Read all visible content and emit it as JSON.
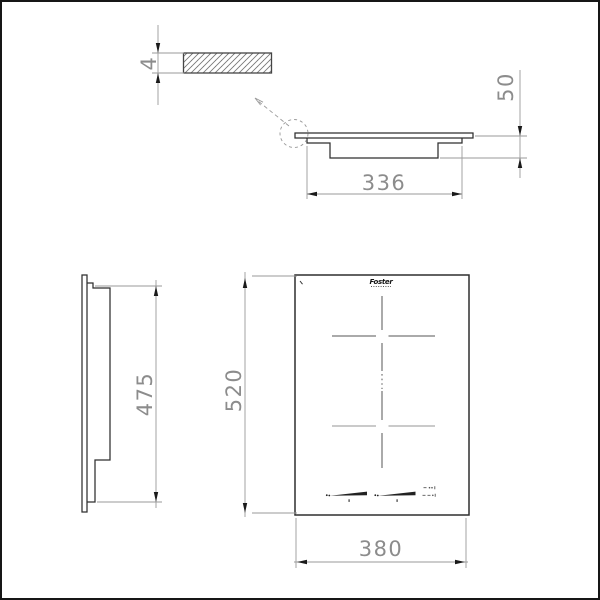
{
  "drawing": {
    "type": "technical-installation-drawing",
    "brand_logo": "Foster",
    "views": {
      "glass_detail": {
        "name": "glass cross-section detail",
        "thickness_label": "4"
      },
      "side_elevation": {
        "name": "side elevation",
        "cutout_width_label": "336",
        "built_in_depth_label": "50"
      },
      "side_profile": {
        "name": "side profile",
        "body_height_label": "475"
      },
      "top_view": {
        "name": "top view",
        "overall_depth_label": "520",
        "overall_width_label": "380"
      }
    },
    "icons": [
      "dimension-arrow-icon",
      "detail-callout-circle-icon",
      "detail-leader-arrow-icon",
      "zone-cross-icon",
      "touch-slider-icon",
      "control-dots-icon"
    ],
    "colors": {
      "object_line": "#2f2f2f",
      "dimension_line": "#9a9a9a",
      "dimension_text": "#8c8c8c",
      "arrow": "#1a1a1a",
      "secondary_cross": "#aaaaaa",
      "background": "#ffffff",
      "border": "#161616"
    }
  }
}
